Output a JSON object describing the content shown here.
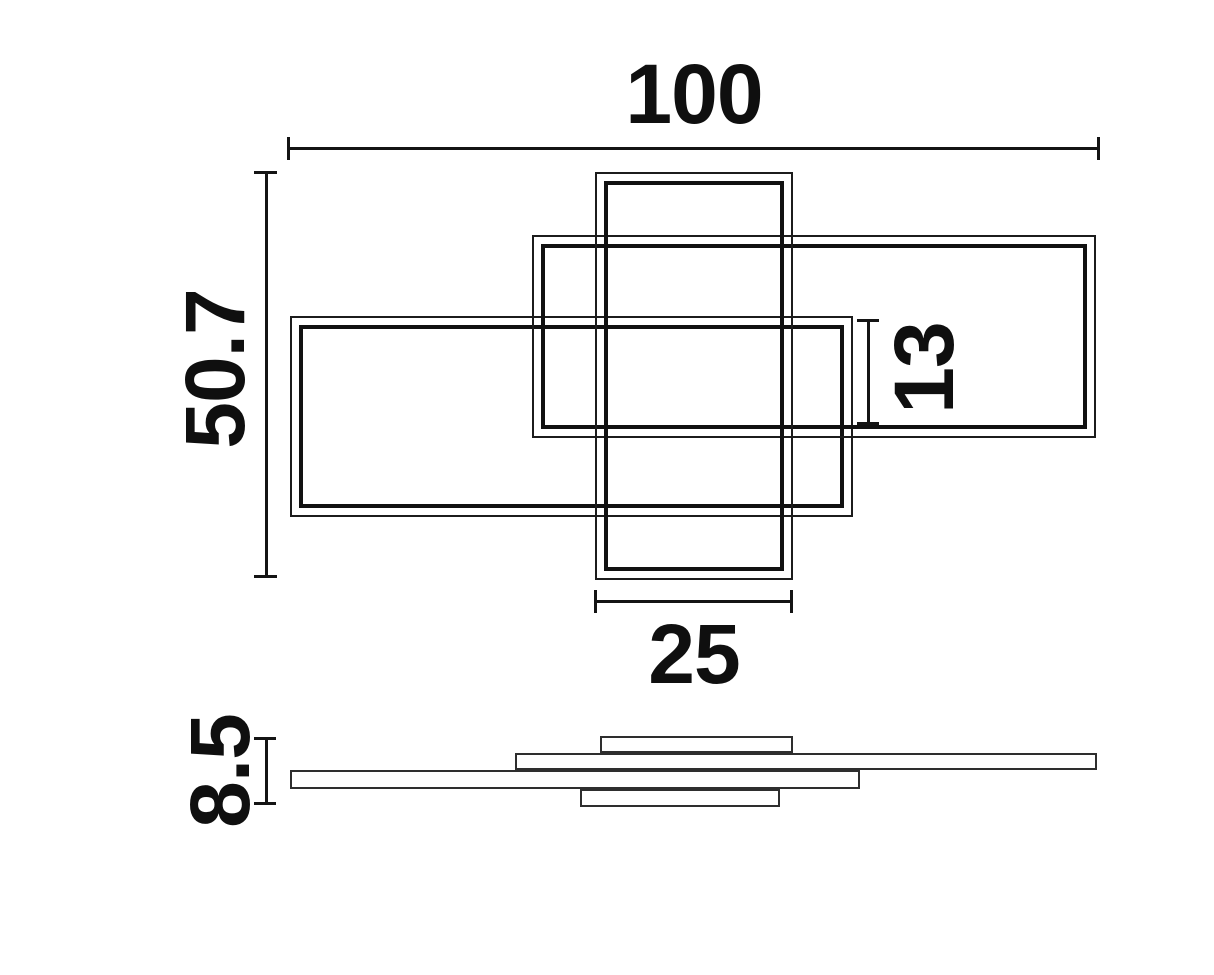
{
  "colors": {
    "background": "#ffffff",
    "line": "#141414"
  },
  "drawing": {
    "kind": "technical dimension drawing",
    "subject": "ceiling light made of three overlapping rectangular frames, top view and side profile view",
    "views": {
      "top_view": "top view with three overlapping double-line rectangular frames",
      "side_view": "side profile view with four thin stacked slats"
    },
    "dimensions": {
      "overall_width": "100",
      "overall_depth": "50.7",
      "frame_overlap_depth": "13",
      "center_frame_width": "25",
      "overall_height": "8.5"
    }
  }
}
